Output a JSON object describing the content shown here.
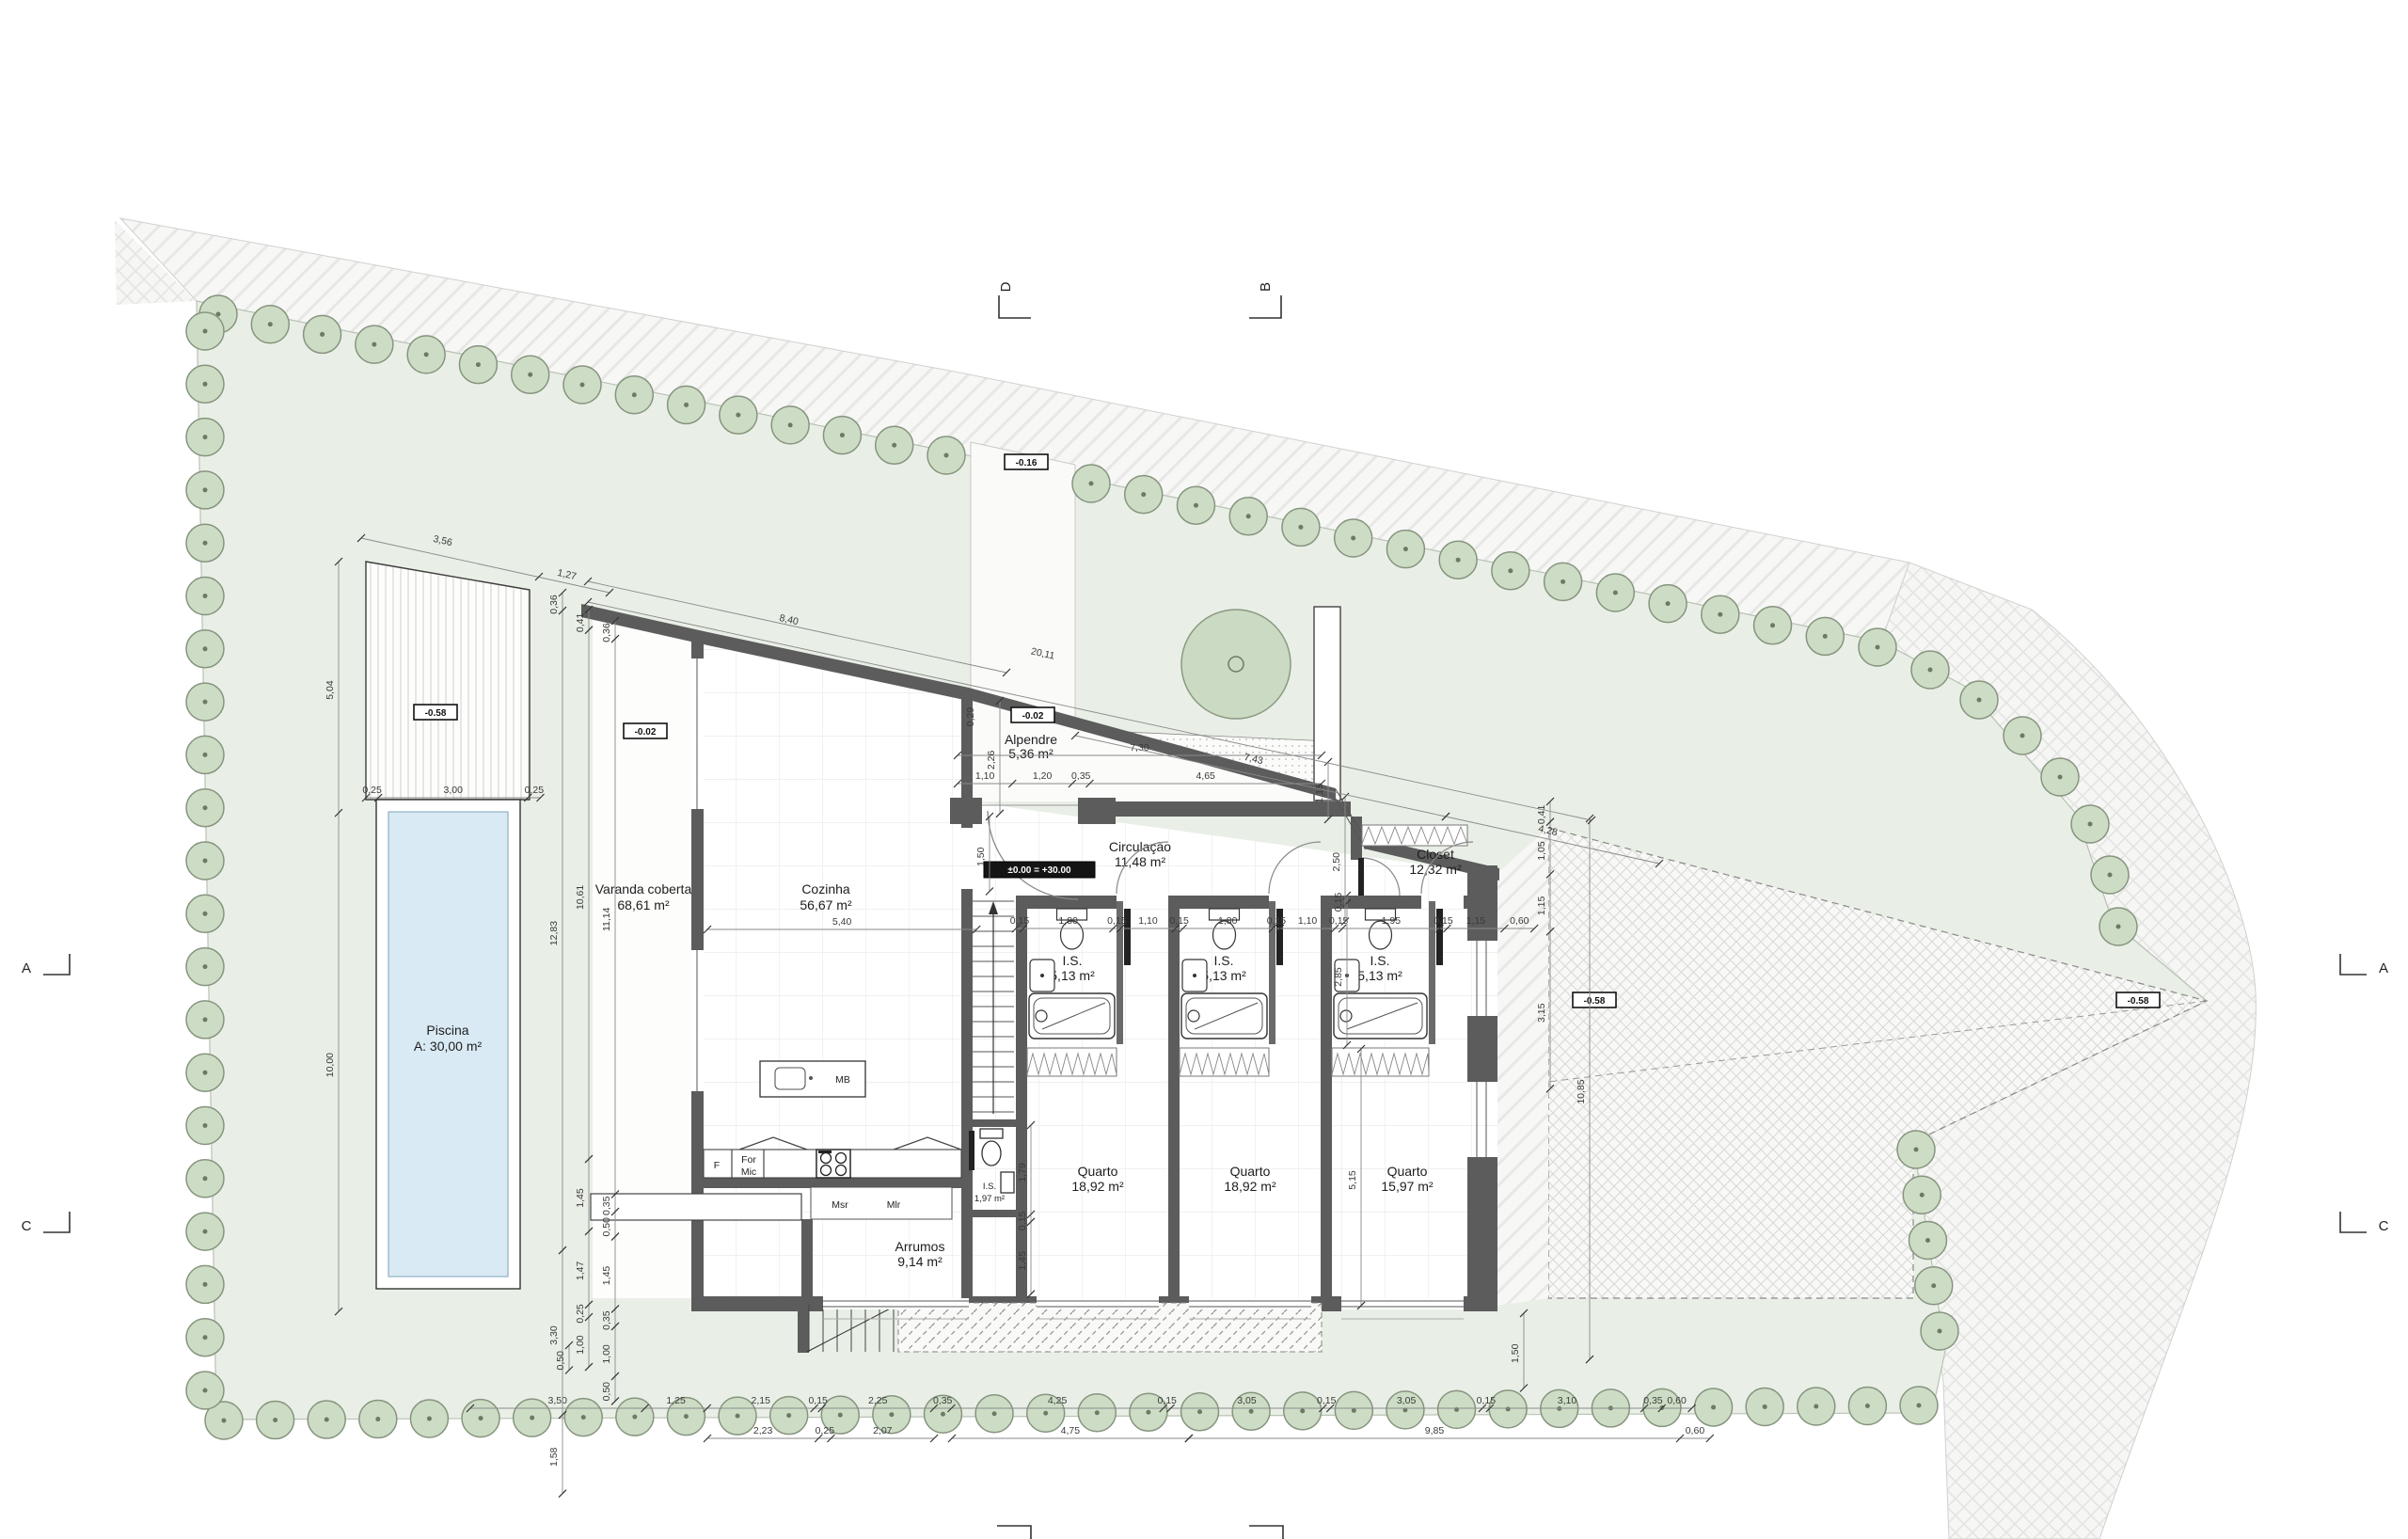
{
  "plan": {
    "rooms": {
      "varanda": {
        "name": "Varanda coberta",
        "area": "68,61 m²"
      },
      "cozinha": {
        "name": "Cozinha",
        "area": "56,67 m²"
      },
      "alpendre": {
        "name": "Alpendre",
        "area": "5,36 m²"
      },
      "circulacao": {
        "name": "Circulação",
        "area": "11,48 m²"
      },
      "closet": {
        "name": "Closet",
        "area": "12,32 m²"
      },
      "is1": {
        "name": "I.S.",
        "area": "5,13 m²"
      },
      "is2": {
        "name": "I.S.",
        "area": "5,13 m²"
      },
      "is3": {
        "name": "I.S.",
        "area": "5,13 m²"
      },
      "is_service": {
        "name": "I.S.",
        "area": "1,97 m²"
      },
      "quarto1": {
        "name": "Quarto",
        "area": "18,92 m²"
      },
      "quarto2": {
        "name": "Quarto",
        "area": "18,92 m²"
      },
      "quarto3": {
        "name": "Quarto",
        "area": "15,97 m²"
      },
      "arrumos": {
        "name": "Arrumos",
        "area": "9,14 m²"
      },
      "piscina": {
        "name": "Piscina",
        "area": "A: 30,00 m²"
      }
    },
    "appliances": {
      "f": "F",
      "forno": "For",
      "mic": "Mic",
      "msr": "Msr",
      "mlr": "Mlr",
      "mb": "MB"
    },
    "levels": {
      "deck": "-0.58",
      "varanda": "-0.02",
      "driveway": "-0.16",
      "alpendre": "-0.02",
      "entrance": "±0.00 = +30.00",
      "patio": "-0.58",
      "boundary": "-0.58"
    },
    "sections": {
      "a": "A",
      "b": "B",
      "c": "C",
      "d": "D"
    },
    "dims": {
      "t1": "3,56",
      "t2": "1,27",
      "t3": "8,40",
      "t4": "20,11",
      "t5": "7,43",
      "t6": "4,28",
      "p1": "5,04",
      "p2": "0,25",
      "p3": "3,00",
      "p4": "0,25",
      "p5": "10,00",
      "m1": "0,36",
      "m2": "0,41",
      "m3": "0,36",
      "m4": "12,83",
      "m5": "10,61",
      "m6": "11,14",
      "m7": "3,30",
      "m8": "1,58",
      "m9": "1,45",
      "m10": "1,47",
      "m11": "0,25",
      "m12": "1,00",
      "m13": "0,35",
      "m14": "0,50",
      "m15": "1,45",
      "m16": "0,35",
      "m17": "1,00",
      "m18": "0,50",
      "a1": "7,30",
      "a2": "1,10",
      "a3": "1,20",
      "a4": "0,35",
      "a5": "4,65",
      "a6": "1,15",
      "a7": "2,26",
      "a8": "1,50",
      "a9": "0,29",
      "k1": "5,40",
      "b1": "0,15",
      "b2": "1,80",
      "b3": "0,15",
      "b4": "1,10",
      "b5": "0,15",
      "b6": "1,80",
      "b7": "0,15",
      "b8": "1,10",
      "b9": "0,15",
      "b10": "1,95",
      "b11": "0,15",
      "b12": "1,15",
      "b13": "0,60",
      "v1": "2,85",
      "v2": "0,15",
      "v3": "5,15",
      "v4": "2,50",
      "r1": "0,41",
      "r2": "1,05",
      "r3": "1,15",
      "r4": "3,15",
      "r5": "10,85",
      "r6": "1,50",
      "s1": "1,79",
      "s2": "0,15",
      "s3": "1,45",
      "c01": "3,50",
      "c02": "1,25",
      "c03": "2,15",
      "c04": "0,15",
      "c05": "2,25",
      "c06": "0,35",
      "c07": "4,25",
      "c08": "0,15",
      "c09": "3,05",
      "c10": "0,15",
      "c11": "3,05",
      "c12": "0,15",
      "c13": "3,10",
      "c14": "0,35",
      "c15": "0,60",
      "c16": "2,23",
      "c17": "0,25",
      "c18": "2,07",
      "c19": "4,75",
      "c20": "9,85",
      "c21": "0,60",
      "c22": "0,50"
    }
  },
  "colors": {
    "site": "#e9efe6",
    "water": "#d9eaf4",
    "pool_border": "#8fb0c4",
    "tree": "#cdddc5",
    "wall": "#5c5c5c"
  }
}
